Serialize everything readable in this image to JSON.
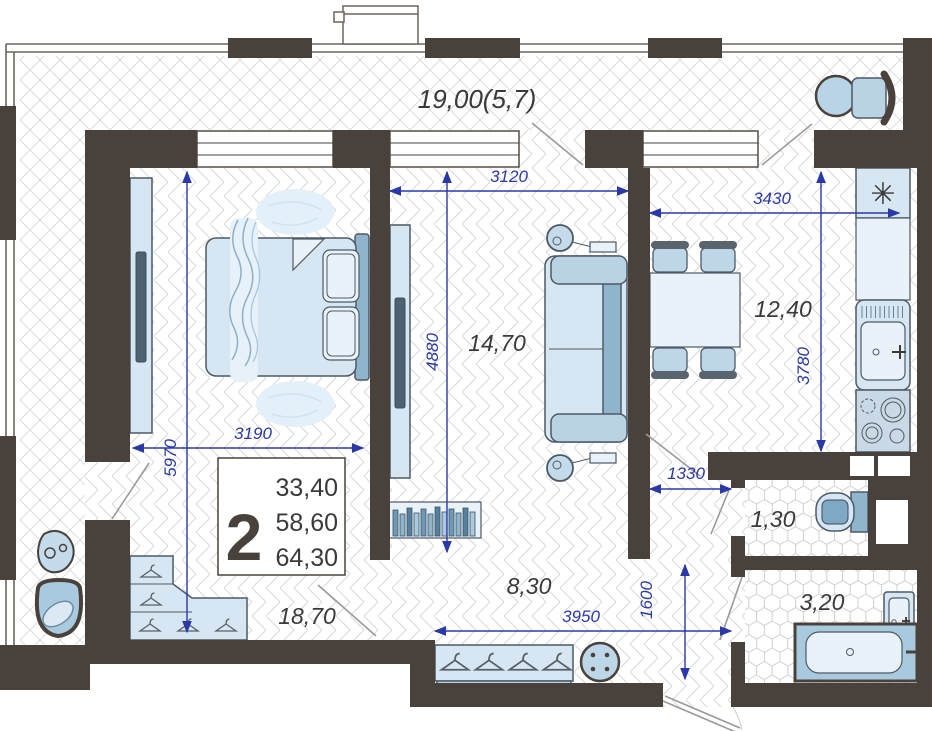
{
  "plan": {
    "balcony_label": "19,00(5,7)",
    "legend": {
      "type": "2",
      "l1": "33,40",
      "l2": "58,60",
      "l3": "64,30"
    },
    "rooms": {
      "bedroom": "18,70",
      "living": "14,70",
      "kitchen": "12,40",
      "hall": "8,30",
      "wc": "1,30",
      "bath": "3,20"
    },
    "dims": {
      "d3120": "3120",
      "d3430": "3430",
      "d4880": "4880",
      "d5970": "5970",
      "d3190": "3190",
      "d3780": "3780",
      "d1330": "1330",
      "d1600": "1600",
      "d3950": "3950"
    },
    "icons": {
      "fridge_symbol": "✳"
    },
    "colors": {
      "wall": "#49423c",
      "dimension": "#2b38a8",
      "furniture_light": "#d6e6f2",
      "furniture_mid": "#b9d2e4",
      "furniture_dark": "#8fb4cc",
      "label": "#3a3a3a"
    }
  }
}
